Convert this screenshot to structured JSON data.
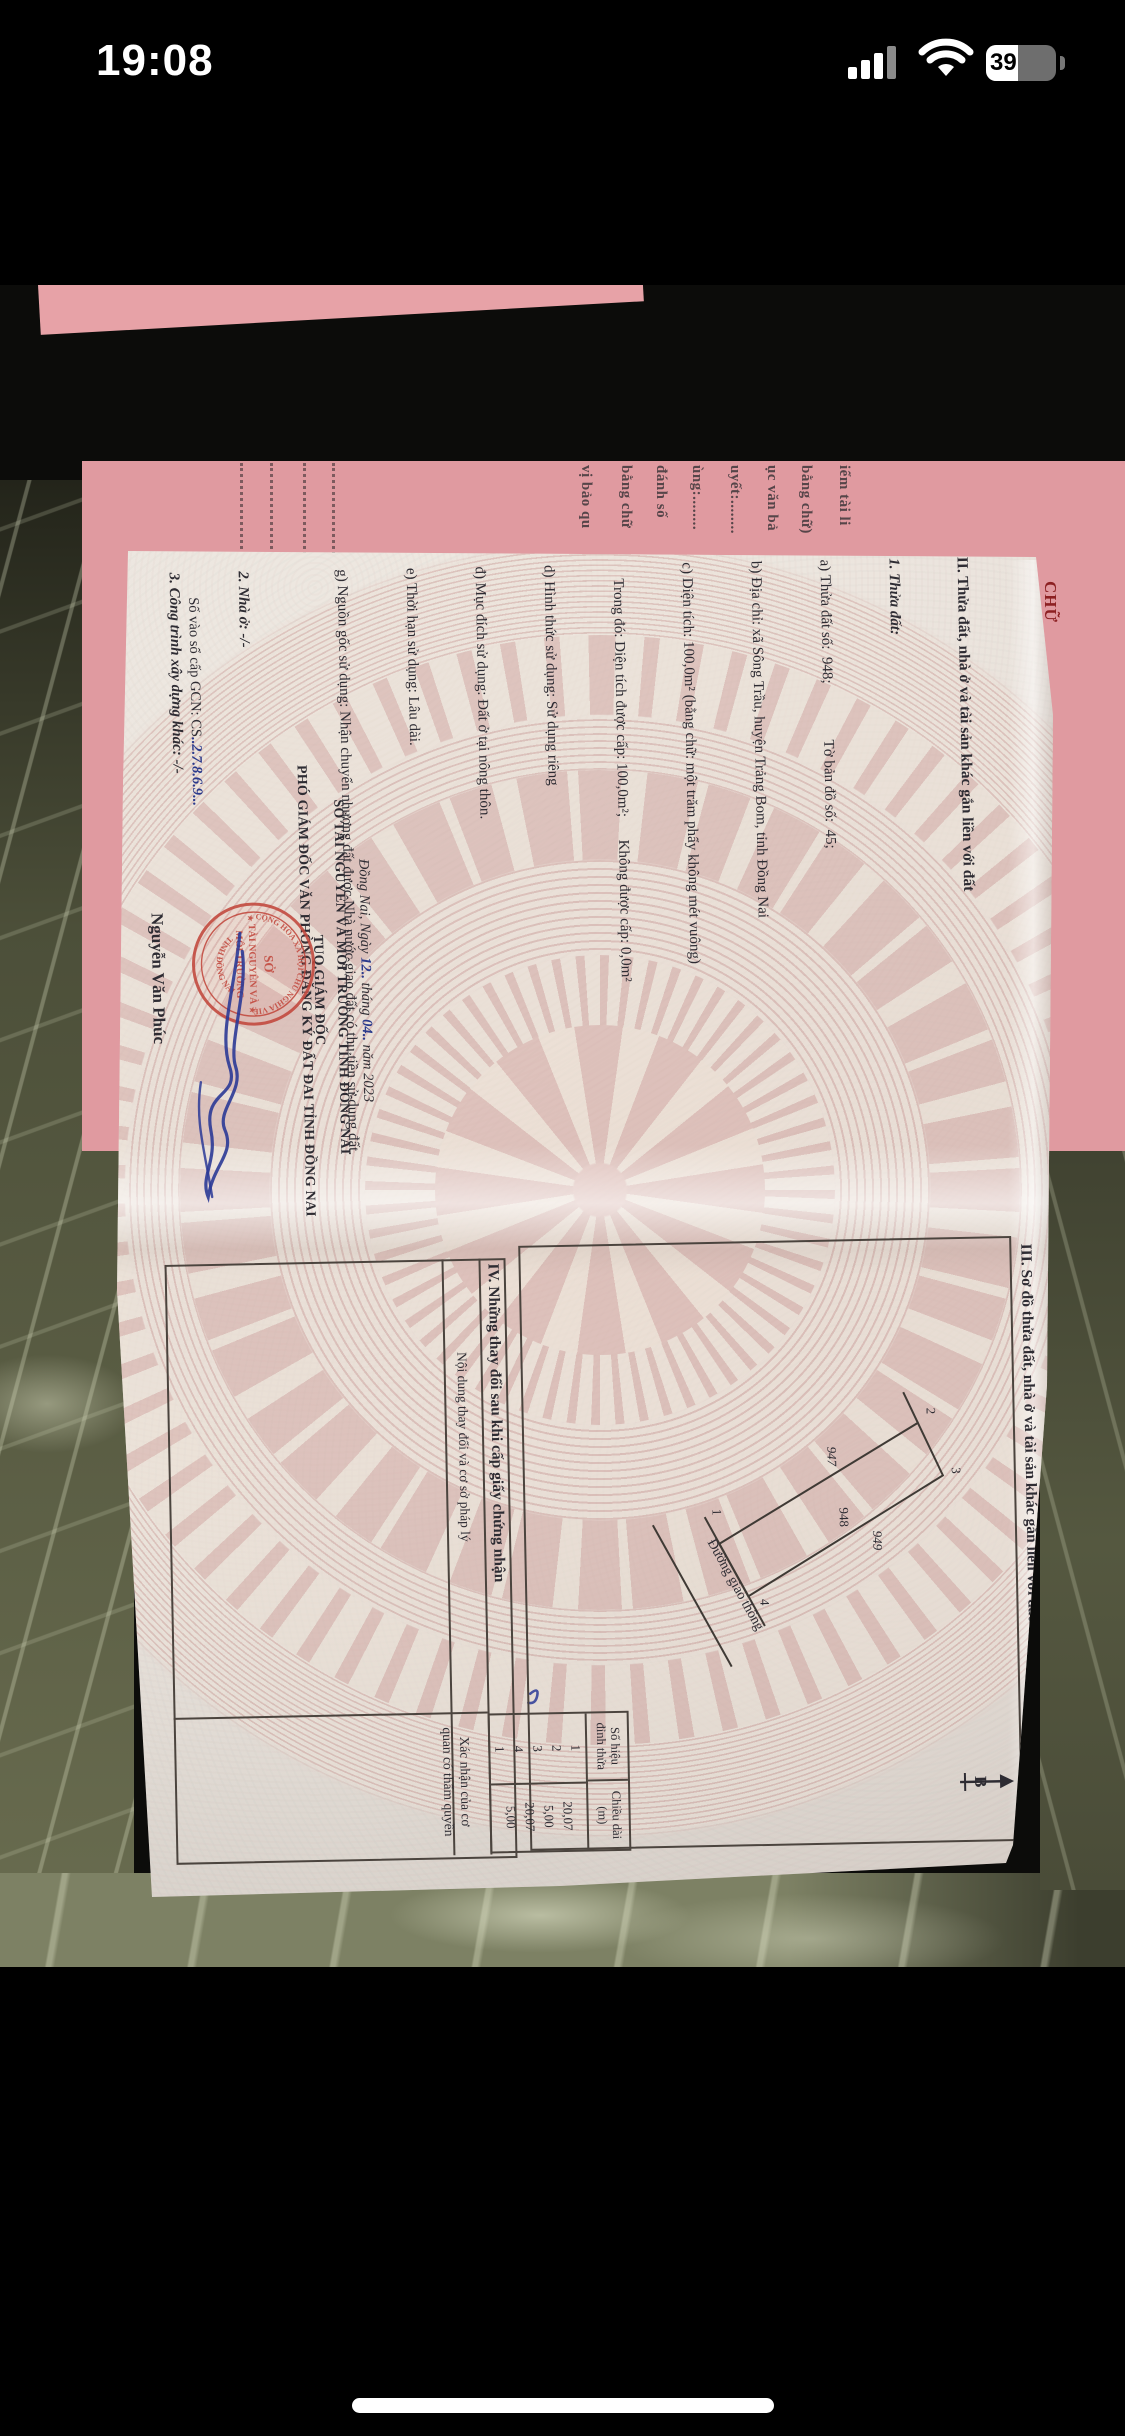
{
  "status_bar": {
    "time": "19:08",
    "battery_percent": "39"
  },
  "cover": {
    "fragments": [
      "vị bảo qu",
      "bằng chữ",
      "đánh số",
      "ùng:........",
      "uyết:........",
      "ục văn bả",
      "bằng chữ)",
      "iểm tài li"
    ],
    "red_fragment": "CHỮ"
  },
  "doc": {
    "section2": {
      "title": "II. Thửa đất, nhà ở và tài sản khác gắn liền với đất",
      "lines": [
        "1. Thửa đất:",
        "a) Thửa đất số:  948;               Tờ bản đồ số:  45;",
        "b) Địa chỉ: xã Sông Trầu, huyện Trảng Bom, tỉnh Đồng Nai",
        "c) Diện tích: 100,0m² (bằng chữ: một trăm phẩy không mét vuông)",
        "    Trong đó: Diện tích được cấp: 100,0m²;      Không được cấp: 0,0m²",
        "d) Hình thức sử dụng: Sử dụng riêng",
        "đ) Mục đích sử dụng: Đất ở tại nông thôn.",
        "e) Thời hạn sử dụng: Lâu dài.",
        "g) Nguồn gốc sử dụng: Nhận chuyển nhượng đất được Nhà nước giao đất có thu tiền sử dụng đất.",
        "2. Nhà ở: -/-",
        "3. Công trình xây dựng khác: -/-",
        "4. Rừng sản xuất là rừng trồng: -/-",
        "5. Cây lâu năm: -/-",
        "6. Ghi chú:"
      ]
    },
    "registry_label": "Số vào sổ cấp GCN: CS",
    "registry_value": "..2.7.8.6.9...",
    "date_prefix": "Đồng Nai, Ngày",
    "date_day": "12..",
    "date_mid": "tháng",
    "date_month": "04..",
    "date_suffix": "năm 2023",
    "issuer_line1": "SỞ TÀI NGUYÊN VÀ MÔI TRƯỜNG TỈNH ĐỒNG NAI",
    "issuer_line2": "TUQ.GIÁM ĐỐC",
    "issuer_line3": "PHÓ GIÁM ĐỐC VĂN PHÒNG ĐĂNG KÝ ĐẤT ĐAI TỈNH ĐỒNG NAI",
    "signer_name": "Nguyễn Văn Phúc",
    "stamp": {
      "ring_top": "CỘNG HÒA XÃ HỘI CHỦ NGHĨA VIỆT NAM",
      "ring_bottom": "TỈNH ĐỒNG NAI",
      "center1": "SỞ",
      "center2": "TÀI NGUYÊN VÀ",
      "center3": "MÔI TRƯỜNG",
      "star": "★"
    },
    "section3": {
      "title": "III. Sơ đồ thửa đất, nhà ở và tài sản khác gắn liền với đất",
      "north_label": "B",
      "road_label": "Đường giao thông",
      "plot_center": "948",
      "plot_left": "947",
      "plot_right": "949",
      "v1": "1",
      "v2": "2",
      "v3": "3",
      "v4": "4",
      "table": {
        "col1": "Số hiệu\nđỉnh thửa",
        "col2": "Chiều dài\n(m)",
        "rows": [
          {
            "v": "1",
            "len": "20,07"
          },
          {
            "v": "2",
            "len": "5,00"
          },
          {
            "v": "3",
            "len": "20,07"
          },
          {
            "v": "4",
            "len": "5,00"
          },
          {
            "v": "1",
            "len": ""
          }
        ]
      }
    },
    "section4": {
      "title": "IV. Những thay đổi sau khi cấp giấy chứng nhận",
      "col1": "Nội dung thay đổi và cơ sở pháp lý",
      "col2": "Xác nhận của cơ\nquan có thẩm quyền"
    }
  }
}
